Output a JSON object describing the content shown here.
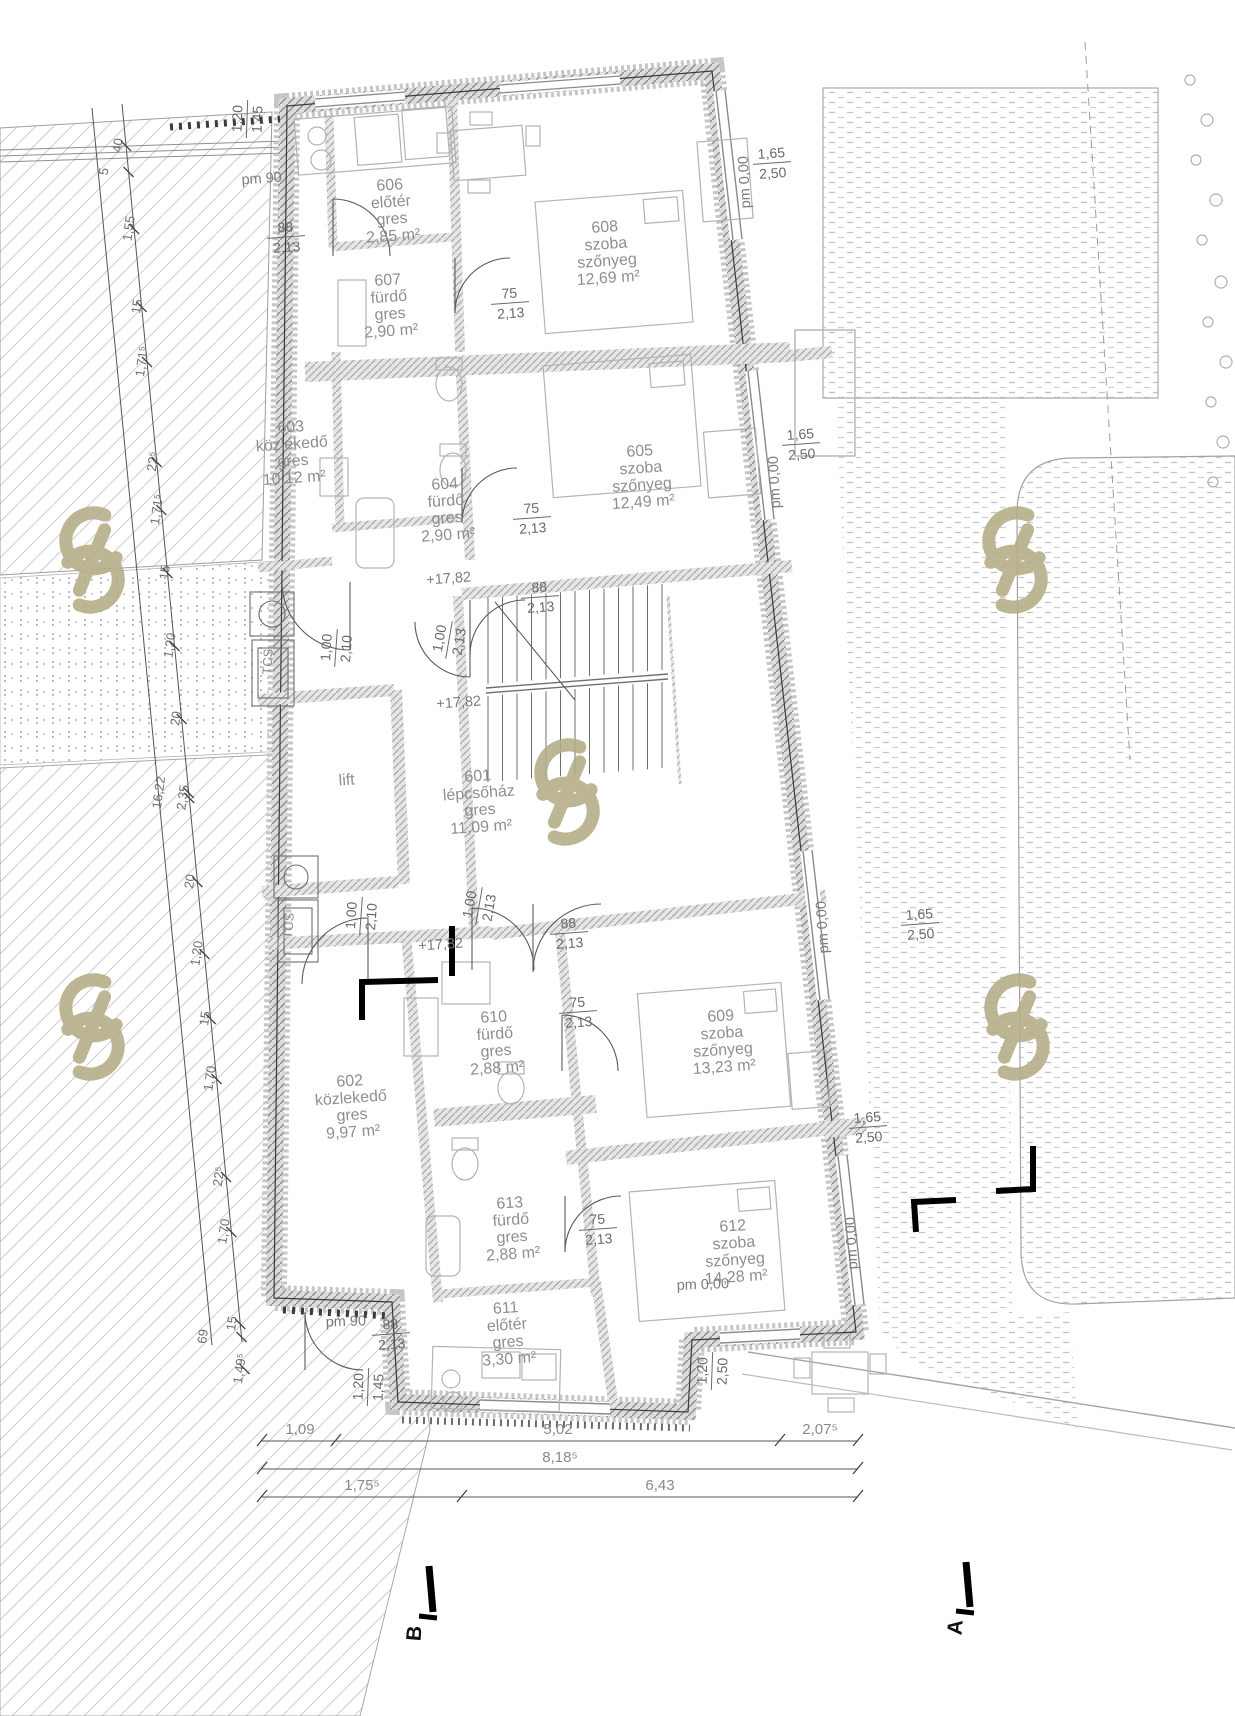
{
  "drawing": {
    "type": "architectural-floor-plan",
    "language": "Hungarian",
    "palette": {
      "line": "#2a2a2a",
      "wall_fill": "#d8d8d8",
      "room_text": "#8f8f8f",
      "dim_text": "#6a6a6a",
      "watermark": "#b5ac87"
    }
  },
  "rooms": [
    {
      "number": "606",
      "name": "előtér",
      "finish": "gres",
      "area": "2,85 m²",
      "x": 390,
      "y": 190,
      "rot": -4
    },
    {
      "number": "607",
      "name": "fürdő",
      "finish": "gres",
      "area": "2,90 m²",
      "x": 388,
      "y": 285,
      "rot": -4
    },
    {
      "number": "608",
      "name": "szoba",
      "finish": "szőnyeg",
      "area": "12,69 m²",
      "x": 605,
      "y": 232,
      "rot": -4
    },
    {
      "number": "605",
      "name": "szoba",
      "finish": "szőnyeg",
      "area": "12,49 m²",
      "x": 640,
      "y": 456,
      "rot": -4
    },
    {
      "number": "603",
      "name": "közlekedő",
      "finish": "gres",
      "area": "10,12 m²",
      "x": 291,
      "y": 432,
      "rot": -4
    },
    {
      "number": "604",
      "name": "fürdő",
      "finish": "gres",
      "area": "2,90 m²",
      "x": 445,
      "y": 489,
      "rot": -4
    },
    {
      "number": "601",
      "name": "lépcsőház",
      "finish": "gres",
      "area": "11,09 m²",
      "x": 478,
      "y": 781,
      "rot": -4
    },
    {
      "number": "lift",
      "name": null,
      "finish": null,
      "area": null,
      "x": 347,
      "y": 785,
      "rot": -4
    },
    {
      "number": "602",
      "name": "közlekedő",
      "finish": "gres",
      "area": "9,97 m²",
      "x": 350,
      "y": 1086,
      "rot": -4
    },
    {
      "number": "610",
      "name": "fürdő",
      "finish": "gres",
      "area": "2,88 m²",
      "x": 494,
      "y": 1022,
      "rot": -4
    },
    {
      "number": "609",
      "name": "szoba",
      "finish": "szőnyeg",
      "area": "13,23 m²",
      "x": 721,
      "y": 1021,
      "rot": -4
    },
    {
      "number": "613",
      "name": "fürdő",
      "finish": "gres",
      "area": "2,88 m²",
      "x": 510,
      "y": 1208,
      "rot": -4
    },
    {
      "number": "611",
      "name": "előtér",
      "finish": "gres",
      "area": "3,30 m²",
      "x": 506,
      "y": 1313,
      "rot": -4
    },
    {
      "number": "612",
      "name": "szoba",
      "finish": "szőnyeg",
      "area": "14,28 m²",
      "x": 733,
      "y": 1231,
      "rot": -4
    }
  ],
  "shaft_labels": [
    {
      "text": "TCS",
      "x": 272,
      "y": 662,
      "rot": -86
    },
    {
      "text": "TCS",
      "x": 293,
      "y": 926,
      "rot": -86
    }
  ],
  "fraction_dims": [
    {
      "t": "88",
      "b": "2,13",
      "x": 286,
      "y": 237,
      "rot": -4
    },
    {
      "t": "75",
      "b": "2,13",
      "x": 510,
      "y": 303,
      "rot": -4
    },
    {
      "t": "75",
      "b": "2,13",
      "x": 532,
      "y": 518,
      "rot": -4
    },
    {
      "t": "88",
      "b": "2,13",
      "x": 540,
      "y": 597,
      "rot": -4
    },
    {
      "t": "88",
      "b": "2,13",
      "x": 569,
      "y": 933,
      "rot": -4
    },
    {
      "t": "75",
      "b": "2,13",
      "x": 578,
      "y": 1012,
      "rot": -4
    },
    {
      "t": "75",
      "b": "2,13",
      "x": 598,
      "y": 1229,
      "rot": -4
    },
    {
      "t": "88",
      "b": "2,13",
      "x": 391,
      "y": 1334,
      "rot": -4
    },
    {
      "t": "1,00",
      "b": "2,10",
      "x": 336,
      "y": 648,
      "rot": -86
    },
    {
      "t": "1,00",
      "b": "2,13",
      "x": 449,
      "y": 640,
      "rot": -80
    },
    {
      "t": "1,00",
      "b": "2,10",
      "x": 361,
      "y": 916,
      "rot": -86
    },
    {
      "t": "1,00",
      "b": "2,13",
      "x": 479,
      "y": 906,
      "rot": -80
    },
    {
      "t": "1,65",
      "b": "2,50",
      "x": 772,
      "y": 163,
      "rot": -4
    },
    {
      "t": "1,65",
      "b": "2,50",
      "x": 801,
      "y": 444,
      "rot": -4
    },
    {
      "t": "1,65",
      "b": "2,50",
      "x": 920,
      "y": 924,
      "rot": -4
    },
    {
      "t": "1,65",
      "b": "2,50",
      "x": 868,
      "y": 1127,
      "rot": -4
    },
    {
      "t": "1,20",
      "b": "2,50",
      "x": 712,
      "y": 1371,
      "rot": -88
    },
    {
      "t": "1,20",
      "b": "1,45",
      "x": 247,
      "y": 119,
      "rot": -88
    },
    {
      "t": "1,20",
      "b": "1,45",
      "x": 368,
      "y": 1387,
      "rot": -88
    }
  ],
  "level_marks": [
    {
      "text": "pm 90",
      "x": 262,
      "y": 183,
      "rot": -4
    },
    {
      "text": "pm 90",
      "x": 346,
      "y": 1326,
      "rot": -2
    },
    {
      "text": "pm 0,00",
      "x": 749,
      "y": 182,
      "rot": -93
    },
    {
      "text": "pm 0,00",
      "x": 779,
      "y": 482,
      "rot": -93
    },
    {
      "text": "pm 0,00",
      "x": 827,
      "y": 927,
      "rot": -93
    },
    {
      "text": "pm 0,00",
      "x": 856,
      "y": 1243,
      "rot": -93
    },
    {
      "text": "pm 0,00",
      "x": 703,
      "y": 1289,
      "rot": -2
    },
    {
      "text": "+17,82",
      "x": 449,
      "y": 583,
      "rot": -4
    },
    {
      "text": "+17,82",
      "x": 459,
      "y": 707,
      "rot": -4
    },
    {
      "text": "+17,82",
      "x": 441,
      "y": 949,
      "rot": -4
    }
  ],
  "left_chain": {
    "line1": [
      92,
      108,
      212,
      1345
    ],
    "line2": [
      122,
      104,
      242,
      1342
    ],
    "labels": [
      {
        "text": "40",
        "x": 122,
        "y": 146
      },
      {
        "text": "5",
        "x": 108,
        "y": 172
      },
      {
        "text": "1,55",
        "x": 133,
        "y": 229
      },
      {
        "text": "15",
        "x": 141,
        "y": 307
      },
      {
        "text": "1,71⁵",
        "x": 146,
        "y": 362
      },
      {
        "text": "22⁵",
        "x": 157,
        "y": 462
      },
      {
        "text": "1,71⁵",
        "x": 161,
        "y": 510
      },
      {
        "text": "15",
        "x": 169,
        "y": 573
      },
      {
        "text": "1,20",
        "x": 174,
        "y": 646
      },
      {
        "text": "20",
        "x": 180,
        "y": 719
      },
      {
        "text": "16,22",
        "x": 163,
        "y": 793
      },
      {
        "text": "2,35",
        "x": 187,
        "y": 798
      },
      {
        "text": "20",
        "x": 194,
        "y": 882
      },
      {
        "text": "1,20",
        "x": 201,
        "y": 954
      },
      {
        "text": "15",
        "x": 209,
        "y": 1019
      },
      {
        "text": "1,70",
        "x": 214,
        "y": 1079
      },
      {
        "text": "22⁵",
        "x": 223,
        "y": 1177
      },
      {
        "text": "1,70",
        "x": 228,
        "y": 1232
      },
      {
        "text": "15",
        "x": 236,
        "y": 1324
      },
      {
        "text": "1,49⁵",
        "x": 244,
        "y": 1369
      },
      {
        "text": "69",
        "x": 207,
        "y": 1337
      }
    ],
    "label_rot": -82
  },
  "bottom_chain": {
    "rows": [
      {
        "y": 1441,
        "x1": 262,
        "x2": 858,
        "ticks": [
          262,
          336,
          780,
          858
        ],
        "labels": [
          {
            "text": "1,09",
            "x": 300
          },
          {
            "text": "5,02",
            "x": 558
          },
          {
            "text": "2,07⁵",
            "x": 820
          }
        ]
      },
      {
        "y": 1469,
        "x1": 262,
        "x2": 858,
        "ticks": [
          262,
          858
        ],
        "labels": [
          {
            "text": "8,18⁵",
            "x": 560
          }
        ]
      },
      {
        "y": 1497,
        "x1": 262,
        "x2": 858,
        "ticks": [
          262,
          462,
          858
        ],
        "labels": [
          {
            "text": "1,75⁵",
            "x": 362
          },
          {
            "text": "6,43",
            "x": 660
          }
        ]
      }
    ]
  },
  "section_markers": [
    {
      "label": "B",
      "x": 421,
      "y": 1634,
      "rot": -85,
      "flag": [
        429,
        1566,
        433,
        1612
      ]
    },
    {
      "label": "A",
      "x": 962,
      "y": 1628,
      "rot": -85,
      "flag": [
        966,
        1562,
        970,
        1607
      ]
    }
  ]
}
